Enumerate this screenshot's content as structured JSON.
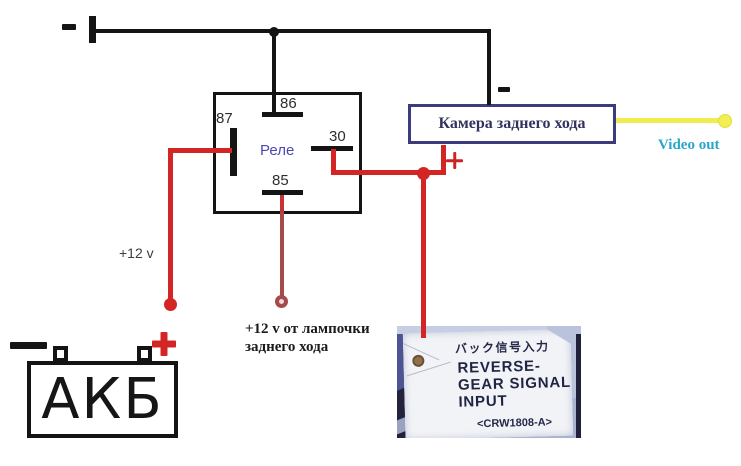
{
  "power": {
    "ground_minus": "-",
    "supply_12v": "+12 v",
    "battery": "АКБ",
    "battery_plus": "+",
    "battery_minus": "-",
    "lamp_supply_line1": "+12 v от лампочки",
    "lamp_supply_line2": "заднего хода"
  },
  "relay": {
    "label": "Реле",
    "pin_87": "87",
    "pin_86": "86",
    "pin_30": "30",
    "pin_85": "85"
  },
  "camera": {
    "label": "Камера заднего хода",
    "minus": "-",
    "plus": "+"
  },
  "video": {
    "label": "Video out"
  },
  "reverse_signal_tag": {
    "japanese": "バック信号入力",
    "english_line1": "REVERSE-",
    "english_line2": "GEAR SIGNAL",
    "english_line3": "INPUT",
    "part_code": "<CRW1808-A>"
  },
  "colors": {
    "wire_red": "#d42525",
    "wire_dark_red": "#a54b4b",
    "wire_black": "#141414",
    "wire_yellow": "#f1ec50",
    "relay_label_text": "#4a49b0",
    "camera_box_border": "#3c3c7c",
    "camera_label_text": "#32325e",
    "video_out_text": "#2ba6c8"
  }
}
